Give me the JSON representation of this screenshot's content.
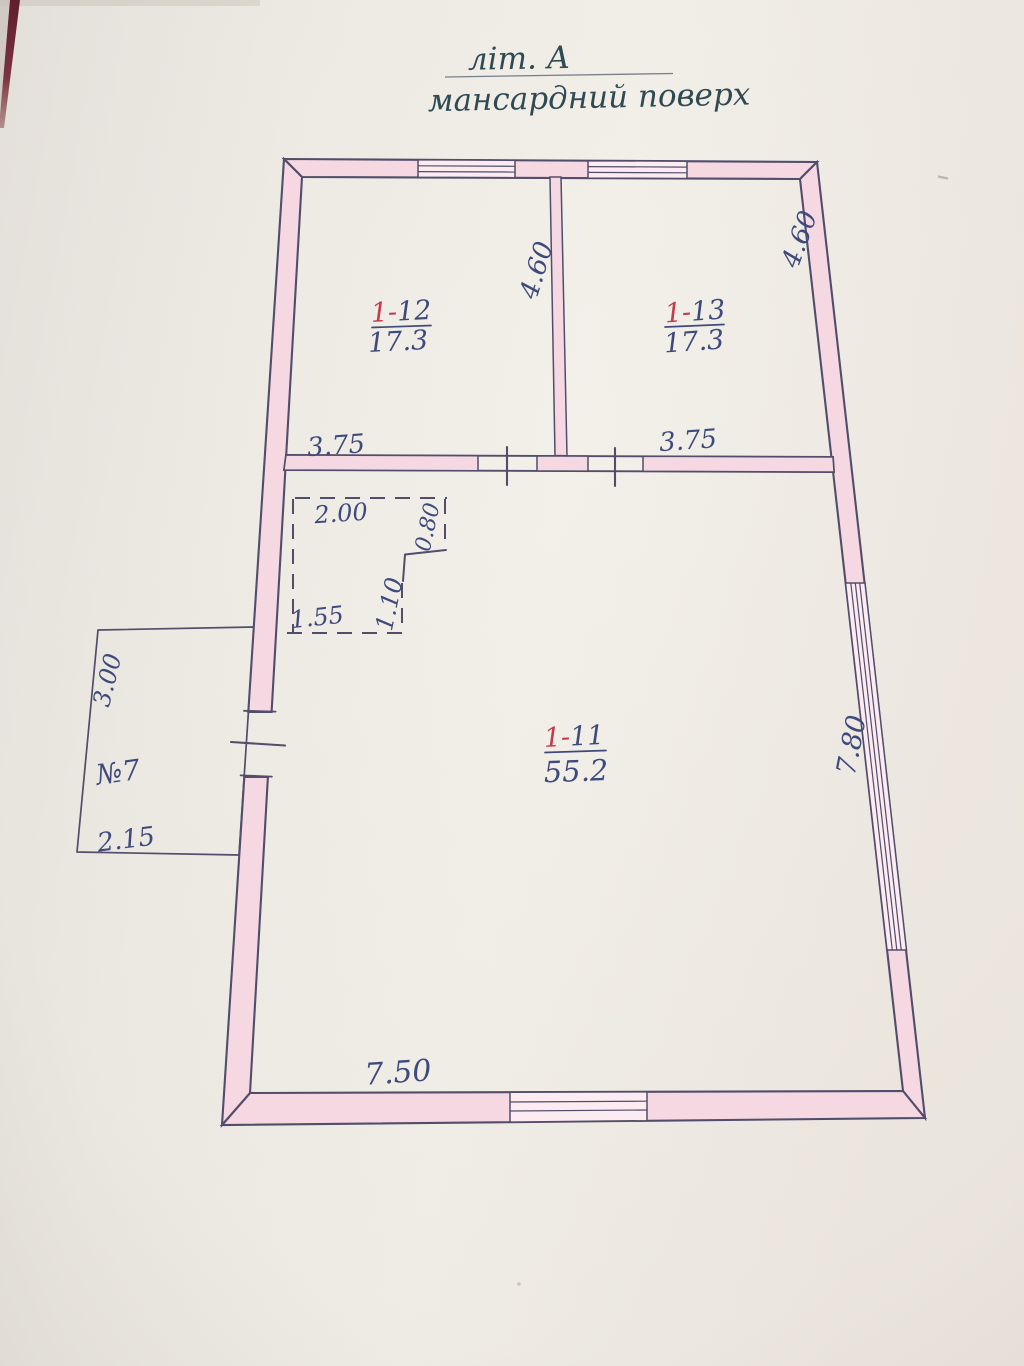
{
  "title": {
    "building_letter": "літ. А",
    "floor_name": "мансардний поверх"
  },
  "rooms": [
    {
      "number_prefix": "1-",
      "number": "12",
      "area": "17.3"
    },
    {
      "number_prefix": "1-",
      "number": "13",
      "area": "17.3"
    },
    {
      "number_prefix": "1-",
      "number": "11",
      "area": "55.2"
    }
  ],
  "dimensions": {
    "room12_width": "3.75",
    "room13_width": "3.75",
    "room12_depth": "4.60",
    "room13_depth": "4.60",
    "hall_width": "7.50",
    "hall_depth": "7.80",
    "niche_width": "2.00",
    "niche_right": "0.80",
    "niche_height": "1.10",
    "niche_bottom": "1.55"
  },
  "annex": {
    "label": "№7",
    "side_dim": "3.00",
    "bottom_dim": "2.15"
  },
  "colors": {
    "paper": "#f0ece6",
    "ink": "#514d6a",
    "ink_blue": "#3f4a7c",
    "ink_red": "#c43a4e",
    "ink_title": "#2f4a52",
    "wall_pink": "#f6d8e2",
    "window_pink": "#fcebf1"
  }
}
